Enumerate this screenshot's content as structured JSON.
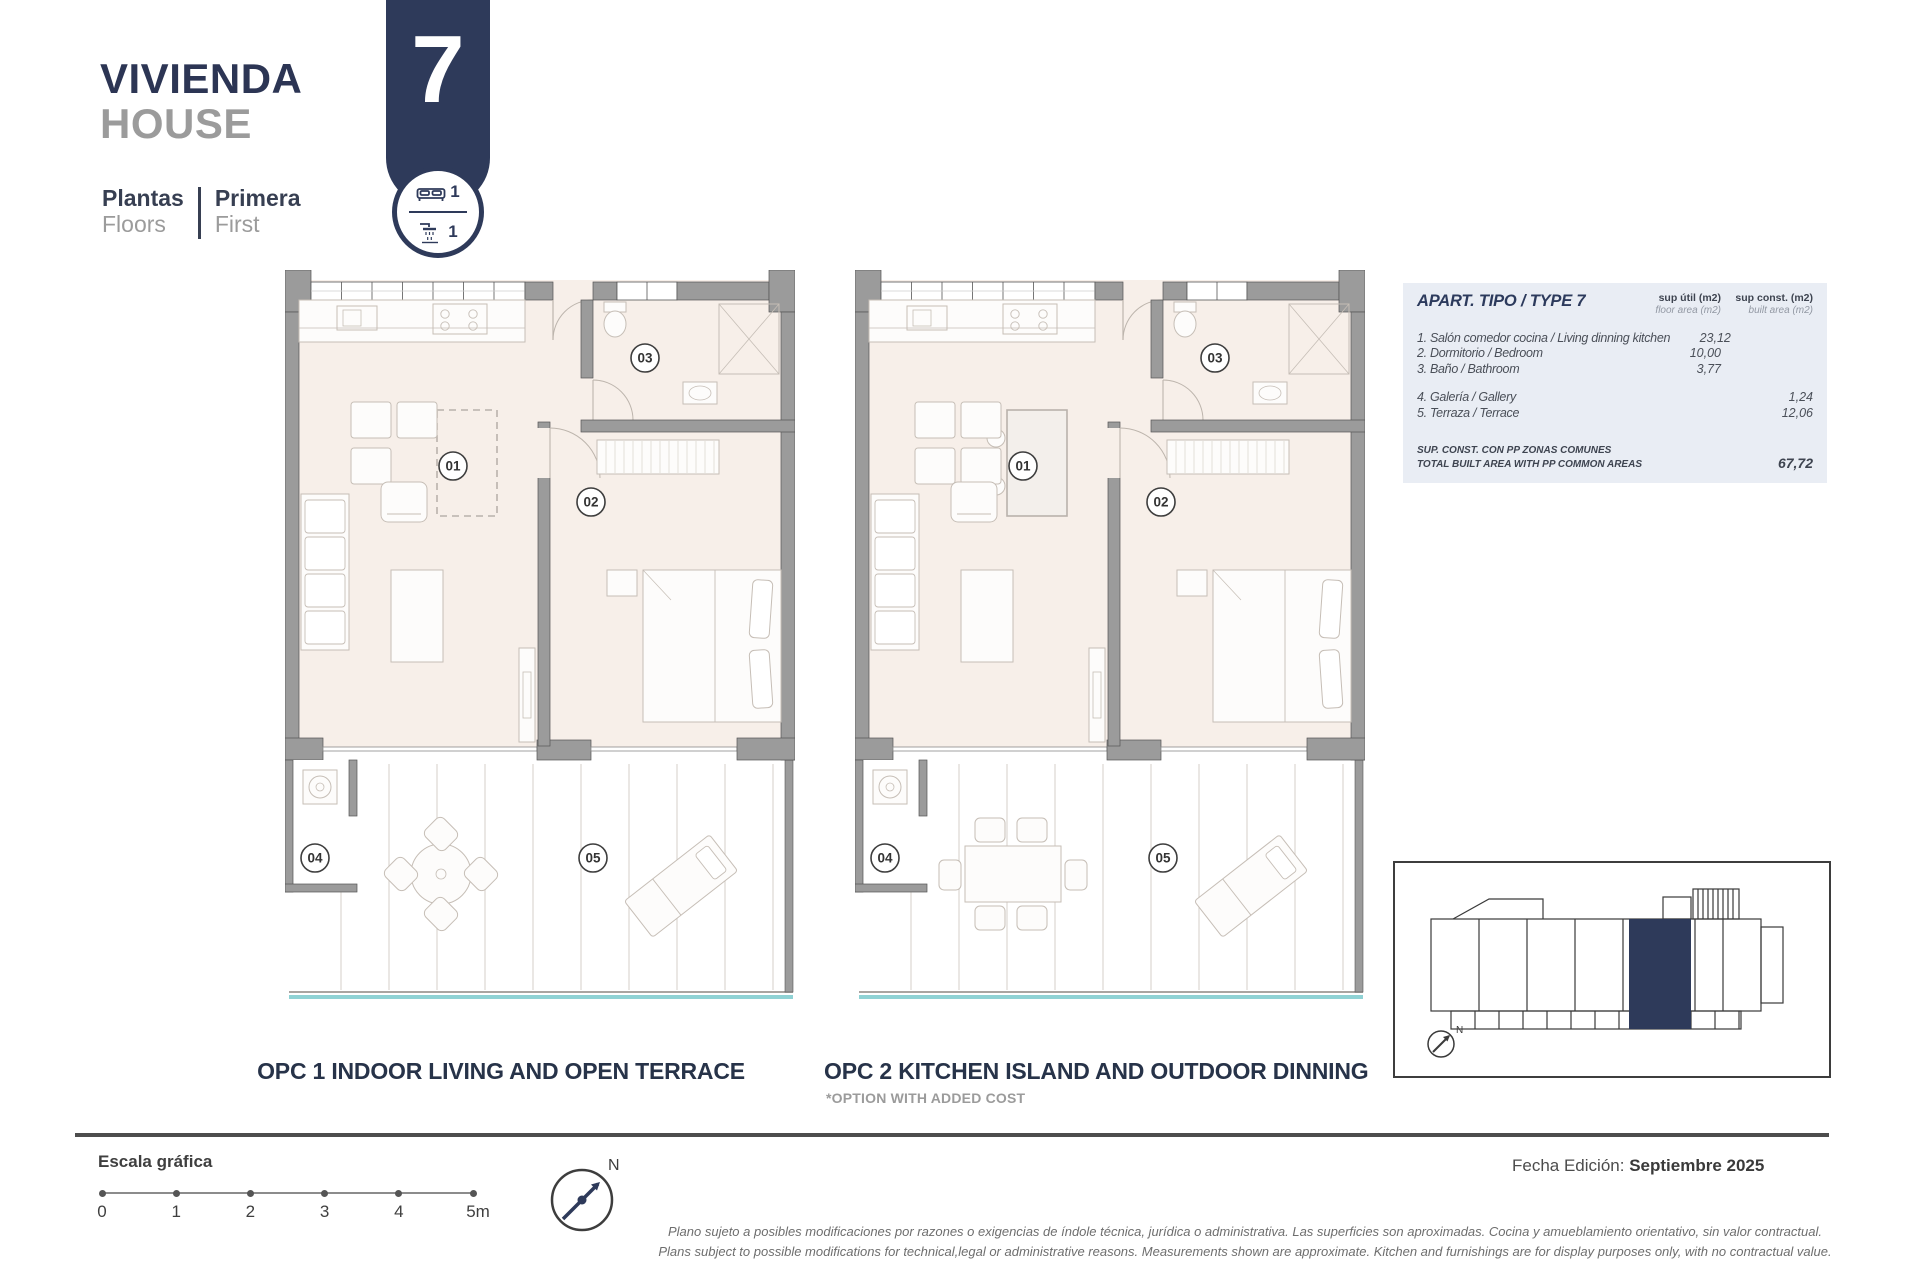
{
  "header": {
    "project_title_es": "VIVIENDA",
    "project_title_en": "HOUSE",
    "floors_label_es": "Plantas",
    "floors_label_en": "Floors",
    "floor_value_es": "Primera",
    "floor_value_en": "First"
  },
  "badge": {
    "unit_number": "7",
    "bedrooms": "1",
    "bathrooms": "1"
  },
  "area_table": {
    "title": "APART. TIPO / TYPE 7",
    "col_floor_label": "sup útil (m2)",
    "col_floor_sublabel": "floor area (m2)",
    "col_built_label": "sup const. (m2)",
    "col_built_sublabel": "built area (m2)",
    "rows": [
      {
        "label": "1. Salón comedor cocina / Living dinning kitchen",
        "floor": "23,12",
        "built": ""
      },
      {
        "label": "2. Dormitorio / Bedroom",
        "floor": "10,00",
        "built": ""
      },
      {
        "label": "3. Baño / Bathroom",
        "floor": "3,77",
        "built": ""
      },
      {
        "label": "4. Galería / Gallery",
        "floor": "",
        "built": "1,24"
      },
      {
        "label": "5. Terraza / Terrace",
        "floor": "",
        "built": "12,06"
      }
    ],
    "total_label_line1": "SUP. CONST. CON PP ZONAS COMUNES",
    "total_label_line2": "TOTAL BUILT AREA WITH PP COMMON AREAS",
    "total_value": "67,72"
  },
  "plans": {
    "room_labels": [
      "01",
      "02",
      "03",
      "04",
      "05"
    ],
    "opc1_caption": "OPC 1 INDOOR LIVING AND OPEN TERRACE",
    "opc2_caption": "OPC 2 KITCHEN ISLAND AND OUTDOOR DINNING",
    "opc2_note": "*OPTION WITH ADDED COST"
  },
  "scale_bar": {
    "label": "Escala gráfica",
    "ticks": [
      "0",
      "1",
      "2",
      "3",
      "4",
      "5m"
    ]
  },
  "compass": {
    "north_label": "N"
  },
  "keyplan": {
    "north_label": "N"
  },
  "footer": {
    "edition_label": "Fecha Edición:",
    "edition_value": "Septiembre 2025",
    "disclaimer_es": "Plano sujeto a posibles modificaciones por razones o exigencias de índole técnica,  jurídica o administrativa. Las superficies son aproximadas. Cocina y amueblamiento orientativo, sin valor contractual.",
    "disclaimer_en": "Plans subject to possible modifications for technical,legal or administrative reasons. Measurements shown are approximate. Kitchen and furnishings are for display purposes only, with no contractual value."
  },
  "colors": {
    "navy": "#2e3a5a",
    "title_gray": "#9b9b9b",
    "wall": "#9b9b9b",
    "wall_edge": "#555555",
    "interior": "#f7efe9",
    "furniture": "#c6beb6",
    "table_bg": "#e9edf4",
    "terrace_edge": "#8fd2d4"
  }
}
